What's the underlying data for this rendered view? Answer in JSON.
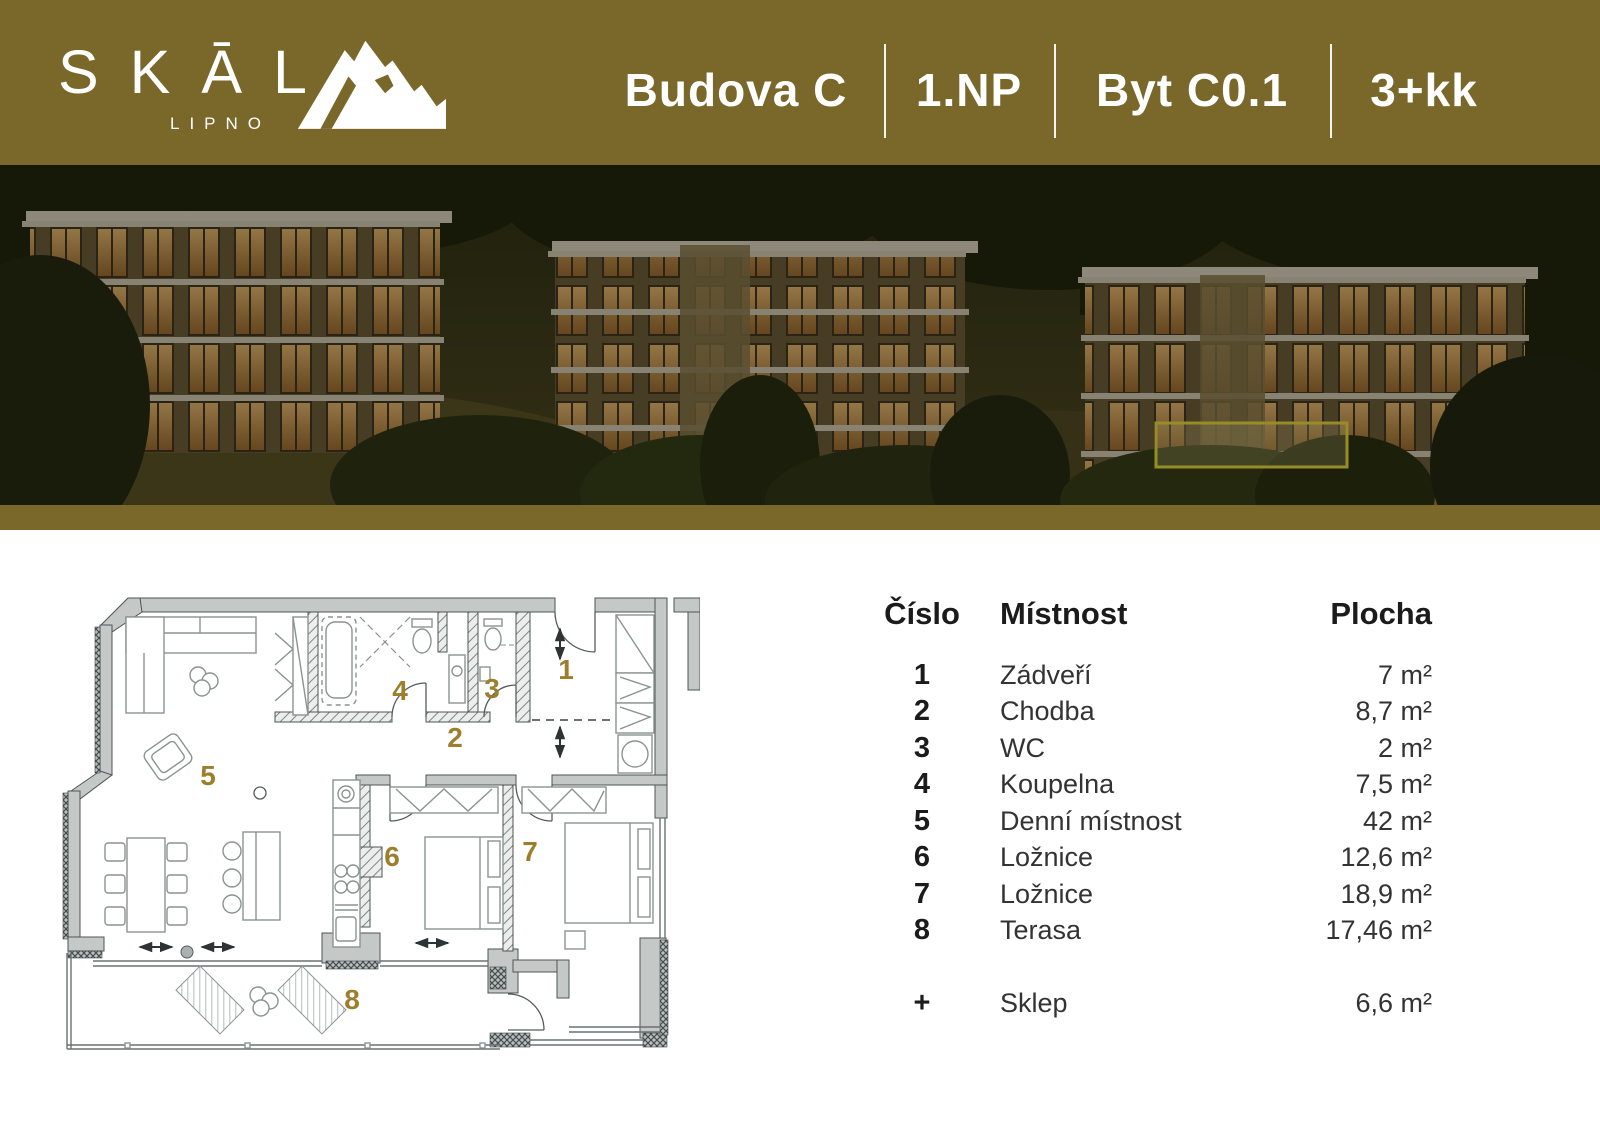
{
  "header": {
    "brand": "SKĀL",
    "brand_sub": "LIPNO",
    "segments": [
      {
        "label": "Budova C"
      },
      {
        "label": "1.NP"
      },
      {
        "label": "Byt C0.1"
      },
      {
        "label": "3+kk"
      }
    ]
  },
  "hero": {
    "description": "dusk rendering of three hillside apartment buildings",
    "highlighted_unit": "ground-floor apartment of right building"
  },
  "plan": {
    "labels": [
      "1",
      "2",
      "3",
      "4",
      "5",
      "6",
      "7",
      "8"
    ]
  },
  "table": {
    "col_number": "Číslo",
    "col_room": "Místnost",
    "col_area": "Plocha",
    "rows": [
      {
        "number": "1",
        "room": "Zádveří",
        "area": "7 m²"
      },
      {
        "number": "2",
        "room": "Chodba",
        "area": "8,7 m²"
      },
      {
        "number": "3",
        "room": "WC",
        "area": "2 m²"
      },
      {
        "number": "4",
        "room": "Koupelna",
        "area": "7,5 m²"
      },
      {
        "number": "5",
        "room": "Denní místnost",
        "area": "42 m²"
      },
      {
        "number": "6",
        "room": "Ložnice",
        "area": "12,6 m²"
      },
      {
        "number": "7",
        "room": "Ložnice",
        "area": "18,9 m²"
      },
      {
        "number": "8",
        "room": "Terasa",
        "area": "17,46 m²"
      },
      {
        "number": "+",
        "room": "Sklep",
        "area": "6,6 m²"
      }
    ]
  },
  "colors": {
    "band_gold": "#7a672a",
    "label_gold": "#9c7e2c",
    "highlight_yellow": "#f2e544"
  }
}
